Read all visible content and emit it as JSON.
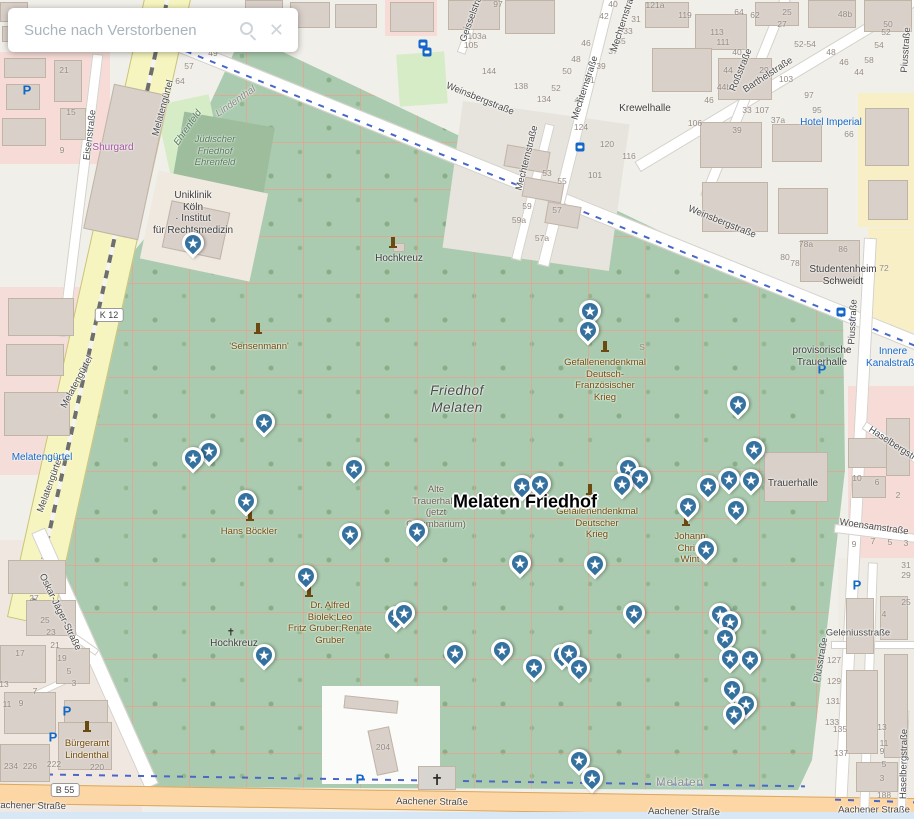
{
  "search": {
    "placeholder": "Suche nach Verstorbenen"
  },
  "map": {
    "main_label": "Melaten Friedhof",
    "accent_colors": {
      "pin": "#35719f",
      "transit_blue": "#1467c8",
      "cemetery_green": "#aacbaf",
      "primary_road": "#fcd6a4",
      "secondary_road": "#f7f5bf"
    },
    "route_badges": [
      {
        "t": "K 12",
        "x": 109,
        "y": 315
      },
      {
        "t": "B 55",
        "x": 65,
        "y": 790
      }
    ],
    "street_labels": [
      {
        "t": "Weinsbergstraße",
        "x": 480,
        "y": 99,
        "r": 22
      },
      {
        "t": "Weinsbergstraße",
        "x": 722,
        "y": 222,
        "r": 22
      },
      {
        "t": "Mechternstraße",
        "x": 527,
        "y": 158,
        "r": -76
      },
      {
        "t": "Mechternstraße",
        "x": 585,
        "y": 88,
        "r": -72
      },
      {
        "t": "Mechternstraße",
        "x": 624,
        "y": 20,
        "r": -72
      },
      {
        "t": "Barthelstraße",
        "x": 768,
        "y": 75,
        "r": -33
      },
      {
        "t": "Roßstraße",
        "x": 741,
        "y": 70,
        "r": -68
      },
      {
        "t": "Geisselstraße",
        "x": 473,
        "y": 14,
        "r": -70
      },
      {
        "t": "Piusstraße",
        "x": 853,
        "y": 322,
        "r": -87
      },
      {
        "t": "Piusstraße",
        "x": 821,
        "y": 660,
        "r": -80
      },
      {
        "t": "Piusstraße",
        "x": 906,
        "y": 50,
        "r": -86
      },
      {
        "t": "Melatengürtel",
        "x": 163,
        "y": 108,
        "r": -75
      },
      {
        "t": "Melatengürtel",
        "x": 77,
        "y": 382,
        "r": -62
      },
      {
        "t": "Melatengürtel",
        "x": 50,
        "y": 485,
        "r": -70
      },
      {
        "t": "Oskar-Jäger-Straße",
        "x": 60,
        "y": 612,
        "r": 64
      },
      {
        "t": "Eisenstraße",
        "x": 90,
        "y": 135,
        "r": -83
      },
      {
        "t": "Aachener Straße",
        "x": 432,
        "y": 802,
        "r": 1
      },
      {
        "t": "Aachener Straße",
        "x": 30,
        "y": 806,
        "r": 1
      },
      {
        "t": "Aachener Straße",
        "x": 684,
        "y": 812,
        "r": 1
      },
      {
        "t": "Aachener Straße",
        "x": 874,
        "y": 810,
        "r": 0
      },
      {
        "t": "Woensamstraße",
        "x": 874,
        "y": 527,
        "r": 8
      },
      {
        "t": "Haselbergstraße",
        "x": 899,
        "y": 448,
        "r": 33
      },
      {
        "t": "Haselbergstraße",
        "x": 904,
        "y": 764,
        "r": -89
      },
      {
        "t": "Geleniusstraße",
        "x": 858,
        "y": 633,
        "r": 0
      }
    ],
    "poi_labels": [
      {
        "lines": [
          "Jüdischer",
          "Friedhof",
          "Ehrenfeld"
        ],
        "x": 215,
        "y": 134,
        "cls": "green-it"
      },
      {
        "lines": [
          "Ehrenfeld"
        ],
        "x": 188,
        "y": 122,
        "cls": "green-it",
        "r": -55
      },
      {
        "lines": [
          "Lindenthal"
        ],
        "x": 236,
        "y": 96,
        "cls": "gray-it",
        "r": -35
      },
      {
        "lines": [
          "Uniklinik",
          "Köln",
          "· Institut",
          "für Rechtsmedizin"
        ],
        "x": 193,
        "y": 190,
        "cls": "dark"
      },
      {
        "lines": [
          "Krewelhalle"
        ],
        "x": 645,
        "y": 103,
        "cls": "dark"
      },
      {
        "lines": [
          "Hotel Imperial"
        ],
        "x": 831,
        "y": 117,
        "cls": "blue"
      },
      {
        "lines": [
          "Studentenheim",
          "Schweidt"
        ],
        "x": 843,
        "y": 264,
        "cls": "dark"
      },
      {
        "lines": [
          "provisorische",
          "Trauerhalle"
        ],
        "x": 822,
        "y": 345,
        "cls": "dark"
      },
      {
        "lines": [
          "Trauerhalle"
        ],
        "x": 793,
        "y": 478,
        "cls": "dark"
      },
      {
        "lines": [
          "Innere",
          "Kanalstraße"
        ],
        "x": 893,
        "y": 346,
        "cls": "blue"
      },
      {
        "lines": [
          "Shurgard"
        ],
        "x": 113,
        "y": 142,
        "cls": "purple"
      },
      {
        "lines": [
          "Melatengürtel"
        ],
        "x": 42,
        "y": 452,
        "cls": "blue"
      },
      {
        "lines": [
          "Friedhof",
          "Melaten"
        ],
        "x": 457,
        "y": 382,
        "cls": "big-it"
      },
      {
        "lines": [
          "Melaten"
        ],
        "x": 680,
        "y": 778,
        "cls": "areagray"
      },
      {
        "lines": [
          "Hans Böckler"
        ],
        "x": 249,
        "y": 526,
        "cls": "brown"
      },
      {
        "lines": [
          "'Sensenmann'"
        ],
        "x": 259,
        "y": 341,
        "cls": "brown"
      },
      {
        "lines": [
          "Dr. Alfred",
          "Biolek;Leo",
          "Fritz Gruber;Renate",
          "Gruber"
        ],
        "x": 330,
        "y": 600,
        "cls": "brown"
      },
      {
        "lines": [
          "Gefallenendenkmal",
          "Deutsch-",
          "Französischer",
          "Krieg"
        ],
        "x": 605,
        "y": 357,
        "cls": "brown"
      },
      {
        "lines": [
          "Gefallenendenkmal",
          "Deutscher",
          "Krieg"
        ],
        "x": 597,
        "y": 506,
        "cls": "brown"
      },
      {
        "lines": [
          "Johann",
          "Christ",
          "Wint"
        ],
        "x": 690,
        "y": 531,
        "cls": "brown"
      },
      {
        "lines": [
          "Alte",
          "Trauerhalle",
          "(jetzt",
          "Columbarium)"
        ],
        "x": 436,
        "y": 484,
        "cls": "warm"
      },
      {
        "lines": [
          "Hochkreuz"
        ],
        "x": 399,
        "y": 253,
        "cls": "dark"
      },
      {
        "lines": [
          "Hochkreuz"
        ],
        "x": 234,
        "y": 638,
        "cls": "dark"
      },
      {
        "lines": [
          "Bürgeramt",
          "Lindenthal"
        ],
        "x": 87,
        "y": 738,
        "cls": "brown"
      }
    ],
    "house_numbers": [
      [
        "121a",
        655,
        5
      ],
      [
        "119",
        685,
        15
      ],
      [
        "113",
        717,
        32
      ],
      [
        "111",
        723,
        42
      ],
      [
        "40",
        737,
        52
      ],
      [
        "44",
        728,
        70
      ],
      [
        "44b",
        724,
        87
      ],
      [
        "46",
        709,
        100
      ],
      [
        "106",
        695,
        123
      ],
      [
        "64",
        739,
        12
      ],
      [
        "62",
        755,
        15
      ],
      [
        "25",
        787,
        12
      ],
      [
        "27",
        782,
        24
      ],
      [
        "29",
        764,
        70
      ],
      [
        "103",
        786,
        79
      ],
      [
        "52-54",
        805,
        44
      ],
      [
        "48",
        831,
        52
      ],
      [
        "46",
        844,
        62
      ],
      [
        "44",
        859,
        72
      ],
      [
        "48b",
        845,
        14
      ],
      [
        "50",
        888,
        24
      ],
      [
        "52",
        886,
        32
      ],
      [
        "54",
        879,
        45
      ],
      [
        "58",
        869,
        60
      ],
      [
        "97",
        809,
        95
      ],
      [
        "95",
        817,
        110
      ],
      [
        "66",
        849,
        134
      ],
      [
        "33",
        747,
        110
      ],
      [
        "107",
        762,
        110
      ],
      [
        "37a",
        778,
        120
      ],
      [
        "39",
        737,
        130
      ],
      [
        "97",
        498,
        4
      ],
      [
        "103a",
        477,
        36
      ],
      [
        "105",
        471,
        45
      ],
      [
        "144",
        489,
        71
      ],
      [
        "138",
        521,
        86
      ],
      [
        "52",
        556,
        88
      ],
      [
        "134",
        544,
        99
      ],
      [
        "124",
        581,
        127
      ],
      [
        "120",
        607,
        144
      ],
      [
        "116",
        629,
        156
      ],
      [
        "101",
        595,
        175
      ],
      [
        "53",
        547,
        173
      ],
      [
        "55",
        562,
        181
      ],
      [
        "59",
        527,
        206
      ],
      [
        "57",
        557,
        210
      ],
      [
        "59a",
        519,
        220
      ],
      [
        "57a",
        542,
        238
      ],
      [
        "46",
        586,
        43
      ],
      [
        "48",
        576,
        59
      ],
      [
        "50",
        567,
        71
      ],
      [
        "41",
        590,
        80
      ],
      [
        "43",
        579,
        100
      ],
      [
        "40",
        613,
        4
      ],
      [
        "42",
        604,
        16
      ],
      [
        "31",
        636,
        19
      ],
      [
        "33",
        628,
        31
      ],
      [
        "35",
        621,
        41
      ],
      [
        "37",
        613,
        51
      ],
      [
        "39",
        601,
        66
      ],
      [
        "78a",
        806,
        244
      ],
      [
        "86",
        843,
        249
      ],
      [
        "80",
        785,
        257
      ],
      [
        "78",
        795,
        263
      ],
      [
        "72",
        884,
        268
      ],
      [
        "21",
        64,
        70
      ],
      [
        "15",
        71,
        112
      ],
      [
        "9",
        62,
        150
      ],
      [
        "57",
        189,
        66
      ],
      [
        "64",
        180,
        81
      ],
      [
        "49",
        213,
        53
      ],
      [
        "27",
        34,
        598
      ],
      [
        "25",
        45,
        620
      ],
      [
        "23",
        51,
        632
      ],
      [
        "21",
        55,
        645
      ],
      [
        "17",
        20,
        653
      ],
      [
        "19",
        62,
        658
      ],
      [
        "5",
        69,
        671
      ],
      [
        "3",
        74,
        683
      ],
      [
        "13",
        4,
        684
      ],
      [
        "7",
        35,
        691
      ],
      [
        "11",
        7,
        704
      ],
      [
        "9",
        21,
        703
      ],
      [
        "234",
        11,
        766
      ],
      [
        "226",
        30,
        766
      ],
      [
        "222",
        54,
        764
      ],
      [
        "220",
        97,
        767
      ],
      [
        "204",
        383,
        747
      ],
      [
        "10",
        857,
        478
      ],
      [
        "6",
        877,
        482
      ],
      [
        "2",
        898,
        495
      ],
      [
        "9",
        854,
        544
      ],
      [
        "7",
        873,
        541
      ],
      [
        "5",
        890,
        542
      ],
      [
        "3",
        906,
        543
      ],
      [
        "31",
        906,
        565
      ],
      [
        "29",
        906,
        575
      ],
      [
        "25",
        906,
        602
      ],
      [
        "4",
        884,
        614
      ],
      [
        "135",
        840,
        729
      ],
      [
        "137",
        841,
        753
      ],
      [
        "13",
        882,
        727
      ],
      [
        "11",
        884,
        743
      ],
      [
        "9",
        882,
        751
      ],
      [
        "5",
        884,
        764
      ],
      [
        "3",
        882,
        778
      ],
      [
        "188",
        884,
        795
      ],
      [
        "127",
        834,
        660
      ],
      [
        "129",
        834,
        681
      ],
      [
        "131",
        833,
        701
      ],
      [
        "133",
        832,
        722
      ],
      [
        "S",
        642,
        347
      ]
    ],
    "pins": [
      [
        196,
        246
      ],
      [
        593,
        314
      ],
      [
        591,
        333
      ],
      [
        741,
        407
      ],
      [
        267,
        425
      ],
      [
        212,
        454
      ],
      [
        196,
        461
      ],
      [
        757,
        452
      ],
      [
        357,
        471
      ],
      [
        525,
        489
      ],
      [
        543,
        487
      ],
      [
        631,
        471
      ],
      [
        625,
        487
      ],
      [
        643,
        481
      ],
      [
        691,
        509
      ],
      [
        711,
        489
      ],
      [
        732,
        482
      ],
      [
        754,
        483
      ],
      [
        739,
        512
      ],
      [
        249,
        504
      ],
      [
        353,
        537
      ],
      [
        420,
        534
      ],
      [
        709,
        552
      ],
      [
        523,
        566
      ],
      [
        598,
        567
      ],
      [
        309,
        579
      ],
      [
        637,
        616
      ],
      [
        399,
        620
      ],
      [
        407,
        616
      ],
      [
        723,
        617
      ],
      [
        733,
        625
      ],
      [
        728,
        641
      ],
      [
        733,
        661
      ],
      [
        753,
        662
      ],
      [
        735,
        692
      ],
      [
        749,
        707
      ],
      [
        737,
        717
      ],
      [
        267,
        658
      ],
      [
        458,
        656
      ],
      [
        505,
        653
      ],
      [
        537,
        670
      ],
      [
        565,
        658
      ],
      [
        572,
        656
      ],
      [
        582,
        671
      ],
      [
        582,
        763
      ],
      [
        595,
        781
      ]
    ],
    "parking": [
      [
        27,
        90
      ],
      [
        67,
        711
      ],
      [
        53,
        737
      ],
      [
        360,
        779
      ],
      [
        857,
        585
      ],
      [
        822,
        369
      ]
    ],
    "transit": [
      [
        423,
        44
      ],
      [
        427,
        52
      ],
      [
        580,
        147
      ],
      [
        841,
        312
      ]
    ],
    "monuments": [
      [
        258,
        332
      ],
      [
        605,
        350
      ],
      [
        590,
        493
      ],
      [
        250,
        519
      ],
      [
        309,
        595
      ],
      [
        686,
        524
      ],
      [
        87,
        730
      ],
      [
        393,
        246
      ]
    ],
    "crosses": [
      {
        "x": 437,
        "y": 780,
        "s": 15
      },
      {
        "x": 231,
        "y": 633,
        "s": 10
      }
    ]
  }
}
